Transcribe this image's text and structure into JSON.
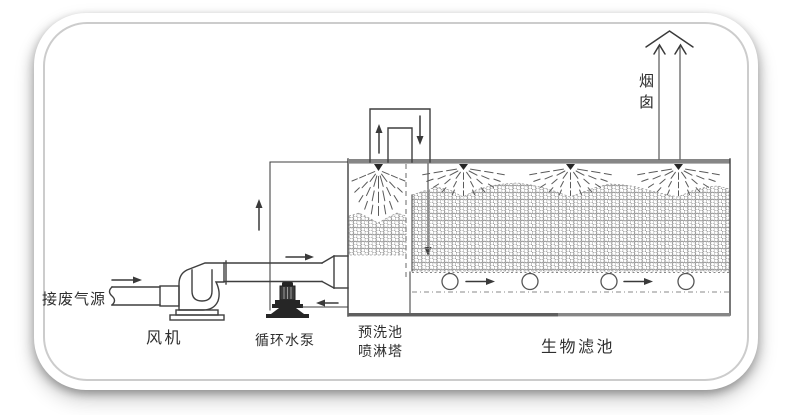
{
  "diagram": {
    "type": "waste-gas-biofilter-process-flow",
    "labels": {
      "inlet_source": "接废气源",
      "fan": "风机",
      "circulating_pump": "循环水泵",
      "prewash_line1": "预洗池",
      "prewash_line2": "喷淋塔",
      "biofilter": "生物滤池",
      "chimney": "烟囱"
    },
    "colors": {
      "line": "#3f3f3f",
      "bar": "#868686",
      "text": "#2e2e2e",
      "card_border": "#cccccc"
    },
    "flow_arrows": [
      {
        "name": "inlet-flow",
        "direction": "right"
      },
      {
        "name": "fan-outlet-flow",
        "direction": "right"
      },
      {
        "name": "pump-riser-flow",
        "direction": "up"
      },
      {
        "name": "pump-suction-flow",
        "direction": "left"
      },
      {
        "name": "tower-outlet-flow",
        "direction": "up"
      },
      {
        "name": "biofilter-inlet-flow",
        "direction": "down"
      },
      {
        "name": "downcomer-flow",
        "direction": "down"
      },
      {
        "name": "bottom-channel-flow-1",
        "direction": "right"
      },
      {
        "name": "bottom-channel-flow-2",
        "direction": "right"
      },
      {
        "name": "chimney-exhaust-flow",
        "direction": "up"
      }
    ]
  }
}
